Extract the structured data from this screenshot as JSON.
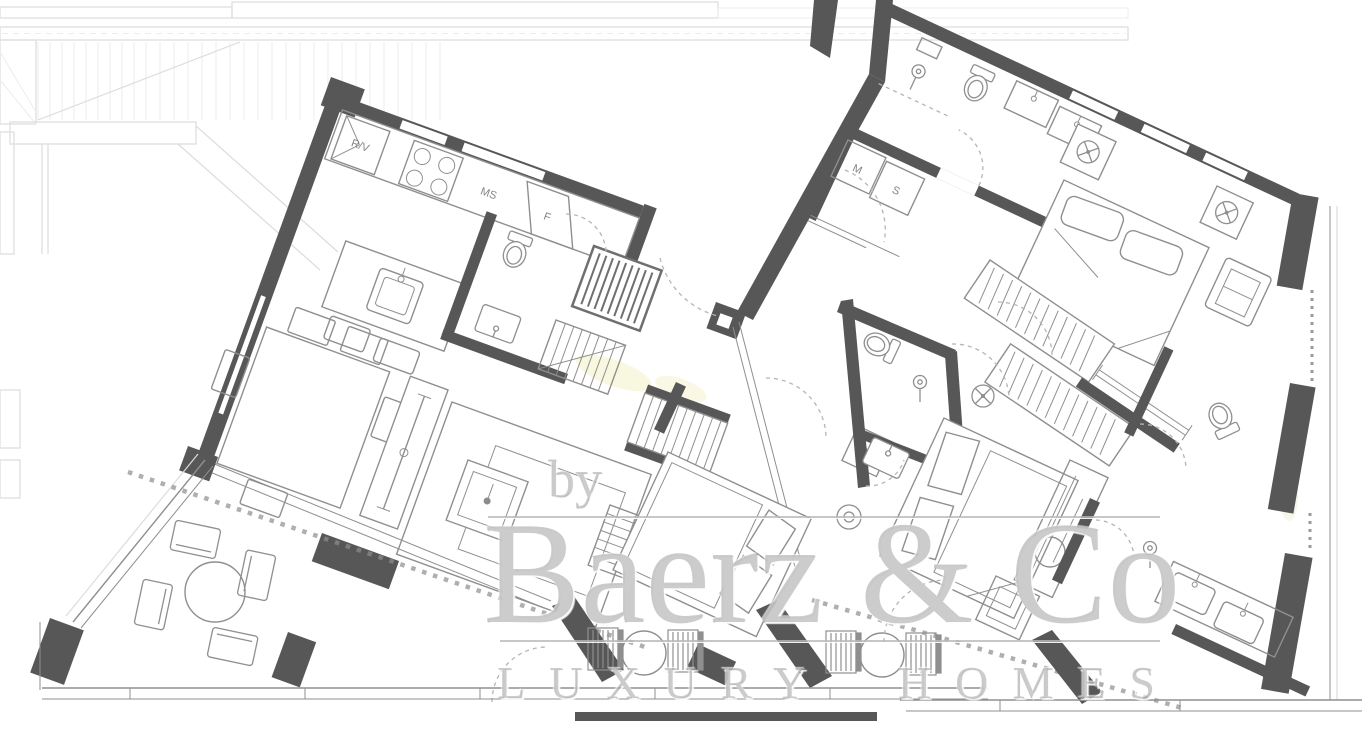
{
  "document": {
    "type": "residential-floor-plan"
  },
  "watermark": {
    "prefix": "by",
    "brand": "Baerz & Co",
    "tagline": "LUXURY HOMES"
  },
  "labels": {
    "rv": "R/V",
    "ms": "MS",
    "f": "F",
    "m": "M",
    "s": "S"
  },
  "colors": {
    "wall": "#575757",
    "line": "#8f8f8f",
    "faint": "#dcdcdc",
    "wm": "#b4b4b4",
    "hl": "#f3f0c4"
  }
}
